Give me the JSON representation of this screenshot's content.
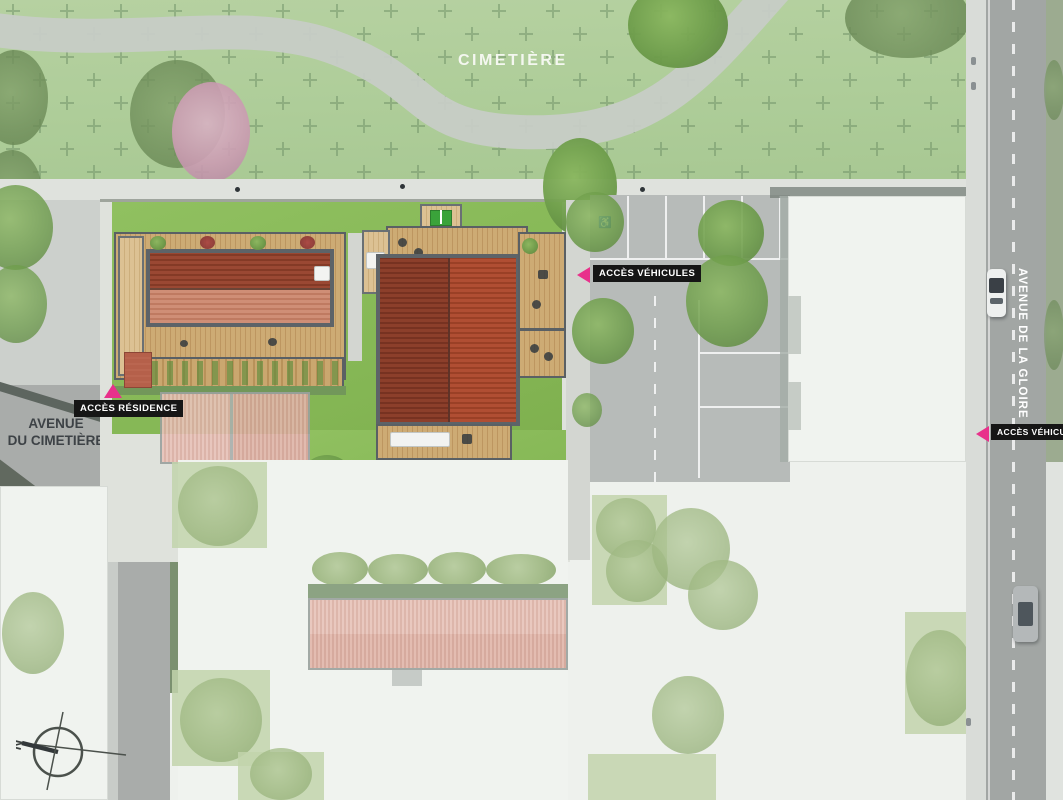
{
  "plan": {
    "area_labels": {
      "cemetery": "CIMETIÈRE"
    },
    "streets": {
      "avenue_cimetiere_line1": "AVENUE",
      "avenue_cimetiere_line2": "DU CIMETIÈRE",
      "rue_drouet": "RUE DROUET",
      "avenue_gloire": "AVENUE DE LA GLOIRE"
    },
    "access": {
      "vehicles_parking": "ACCÈS VÉHICULES",
      "vehicles_avenue": "ACCÈS VÉHICULES",
      "residence": "ACCÈS RÉSIDENCE"
    },
    "compass": {
      "north": "N"
    },
    "icons": {
      "disabled_parking_icon": "♿"
    },
    "colors": {
      "accent_pink": "#e8318b",
      "label_bg": "#161616",
      "label_text": "#ffffff",
      "cemetery_green": "#b2cf9d",
      "garden_green": "#8cbd5d",
      "deck_wood": "#c9a76f",
      "roof_dark_red": "#8c3f2b",
      "roof_light_red": "#c07c63",
      "road_gray": "#a6a9a7"
    }
  }
}
